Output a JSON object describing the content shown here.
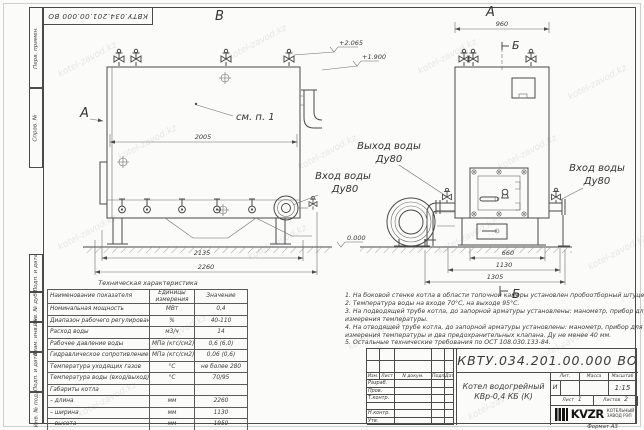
{
  "watermark": {
    "text": "kotel-zavod.kz"
  },
  "colors": {
    "line": "#4a4a4a",
    "text": "#3a3a3a",
    "paper": "#fbfbf9"
  },
  "frame": {
    "top_designation": "КВТУ.034.201.00.000  ВО",
    "left_stamps_top": [
      "Перв. примен.",
      "Справ. №"
    ],
    "left_stamps_bottom": [
      "Подп. и дата",
      "Инв. № дубл.",
      "Взам. инв. №",
      "Подп. и дата",
      "Инв. № подл."
    ],
    "format_label": "Формат  А3"
  },
  "drawing": {
    "view_top_left": "В",
    "view_top_right": "А",
    "view_arrow_left": "А",
    "section_mark_top": "Б",
    "section_mark_bottom": "Б",
    "see_note_label": "см. п. 1",
    "outlet_label_line1": "Выход воды",
    "outlet_label_line2": "Ду80",
    "inlet_right_line1": "Вход воды",
    "inlet_right_line2": "Ду80",
    "inlet_left_line1": "Вход воды",
    "inlet_left_line2": "Ду80",
    "elevation_top": "+2.065",
    "elevation_mid": "+1.900",
    "elevation_zero": "0.000",
    "dim_left_width": "2005",
    "dim_left_base": "2135",
    "dim_left_overall": "2260",
    "dim_right_top": "960",
    "dim_right_b1": "660",
    "dim_right_b2": "1130",
    "dim_right_b3": "1305"
  },
  "tech_table": {
    "title": "Техническая характеристика",
    "headers": [
      "Наименование показателя",
      "Единицы измерения",
      "Значение"
    ],
    "rows": [
      [
        "Номинальная мощность",
        "МВт",
        "0,4"
      ],
      [
        "Диапазон рабочего регулирования",
        "%",
        "40-110"
      ],
      [
        "Расход воды",
        "м3/ч",
        "14"
      ],
      [
        "Рабочее давление воды",
        "МПа (кгс/см2)",
        "0,6 (6,0)"
      ],
      [
        "Гидравлическое сопротивление котла",
        "МПа (кгс/см2)",
        "0,06 (0,6)"
      ],
      [
        "Температура уходящих газов",
        "°С",
        "не более 280"
      ],
      [
        "Температура воды (вход/выход)",
        "°С",
        "70/95"
      ],
      [
        "Габариты котла",
        "",
        ""
      ],
      [
        "– длина",
        "мм",
        "2260"
      ],
      [
        "– ширина",
        "мм",
        "1130"
      ],
      [
        "– высота",
        "мм",
        "1950"
      ]
    ]
  },
  "notes": {
    "lines": [
      "1. На боковой стенке котла в области топочной камеры установлен пробоотборный штуцер",
      "2. Температура воды на входе 70°С, на выходе 95°С.",
      "3. На подводящей трубе котла, до запорной арматуры установлены: манометр, прибор для",
      "измерения температуры.",
      "4. На отводящей трубе котла, до запорной арматуры установлены: манометр, прибор для",
      "измерения температуры и два предохранительных клапана. Ду не менее 40 мм.",
      "5. Остальные технические требования по ОСТ 108.030.133-84."
    ]
  },
  "title_block": {
    "designation": "КВТУ.034.201.00.000  ВО",
    "name_line1": "Котел водогрейный",
    "name_line2": "КВр-0,4  КБ  (К)",
    "columns": [
      "Изм.",
      "Лист",
      "N докум.",
      "Подп.",
      "Дата"
    ],
    "roles": [
      "Разраб.",
      "Пров.",
      "Т.контр.",
      "",
      "Н.контр.",
      "Утв."
    ],
    "lit_label": "Лит.",
    "lit_value": "И",
    "mass_label": "Масса",
    "scale_label": "Масштаб",
    "scale_value": "1:15",
    "sheet_label": "Лист",
    "sheet_value": "1",
    "sheets_label": "Листов",
    "sheets_value": "2",
    "logo_name": "KVZR",
    "logo_line1": "КОТЕЛЬНЫЙ",
    "logo_line2": "ЗАВОД РЭП"
  }
}
